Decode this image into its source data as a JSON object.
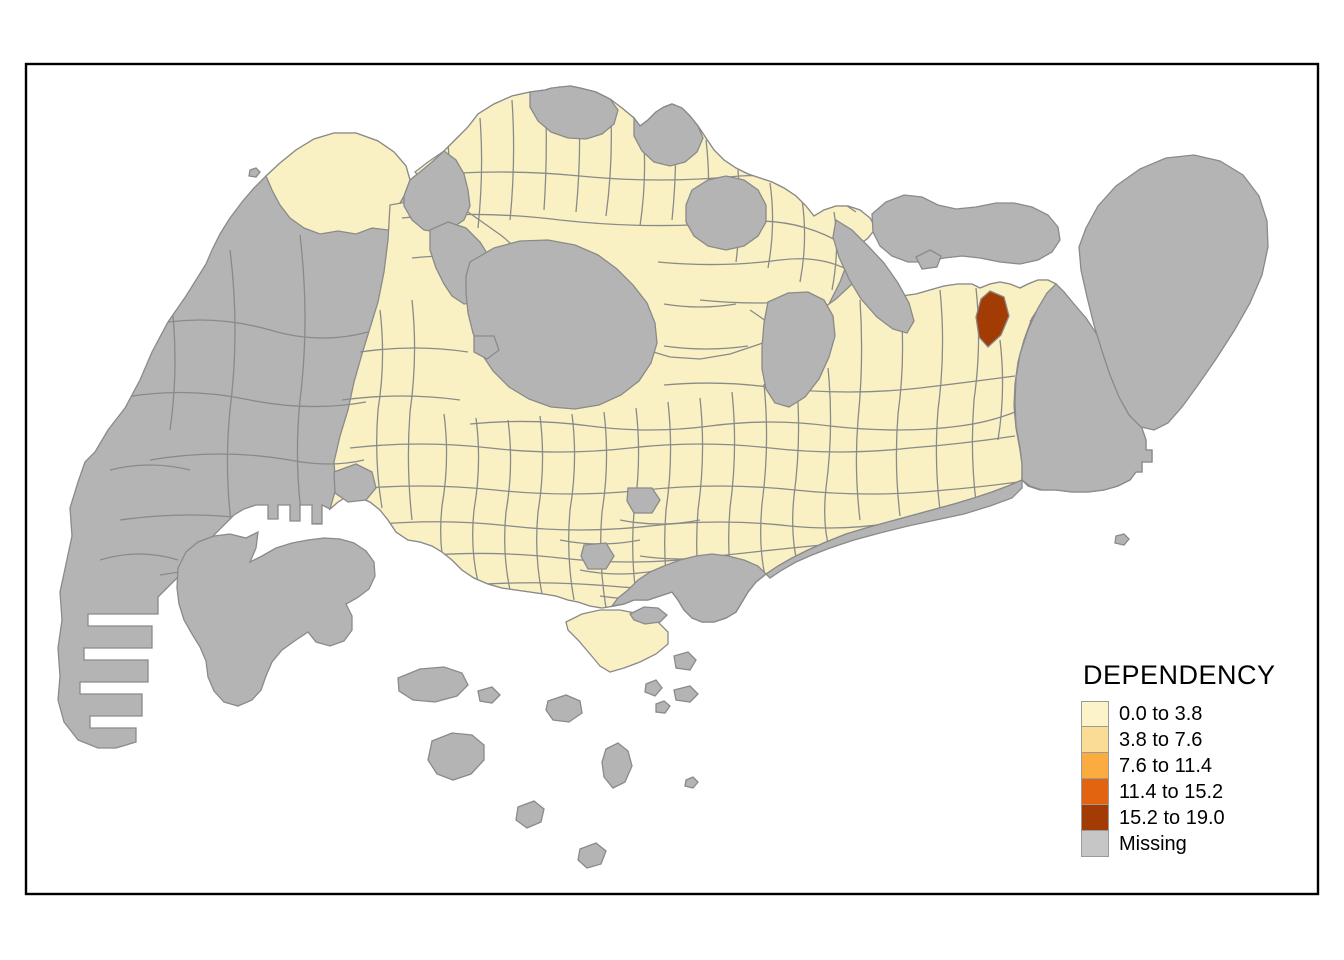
{
  "figure": {
    "type": "choropleth-map",
    "region_shown": "Singapore planning subzones",
    "frame_color": "#000000",
    "sea_color": "#ffffff"
  },
  "legend": {
    "title": "DEPENDENCY",
    "items": [
      {
        "label": "0.0 to 3.8",
        "color": "#FDF3C9"
      },
      {
        "label": "3.8 to 7.6",
        "color": "#FBDC95"
      },
      {
        "label": "7.6 to 11.4",
        "color": "#FBAC40"
      },
      {
        "label": "11.4 to 15.2",
        "color": "#E26310"
      },
      {
        "label": "15.2 to 19.0",
        "color": "#A33B04"
      },
      {
        "label": "Missing",
        "color": "#C6C6C6"
      }
    ]
  },
  "map": {
    "class1_fill": "#F9F1C3",
    "class5_fill": "#A33B04",
    "missing_fill": "#B4B4B4",
    "border_color": "#8A8A8A",
    "notes": "Most populated subzones fall in class 0.0-3.8 (pale yellow); one subzone near Pasir Ris/Loyang falls in class 15.2-19.0 (dark red); industrial, military, reservoir and offshore areas are Missing (gray)."
  }
}
